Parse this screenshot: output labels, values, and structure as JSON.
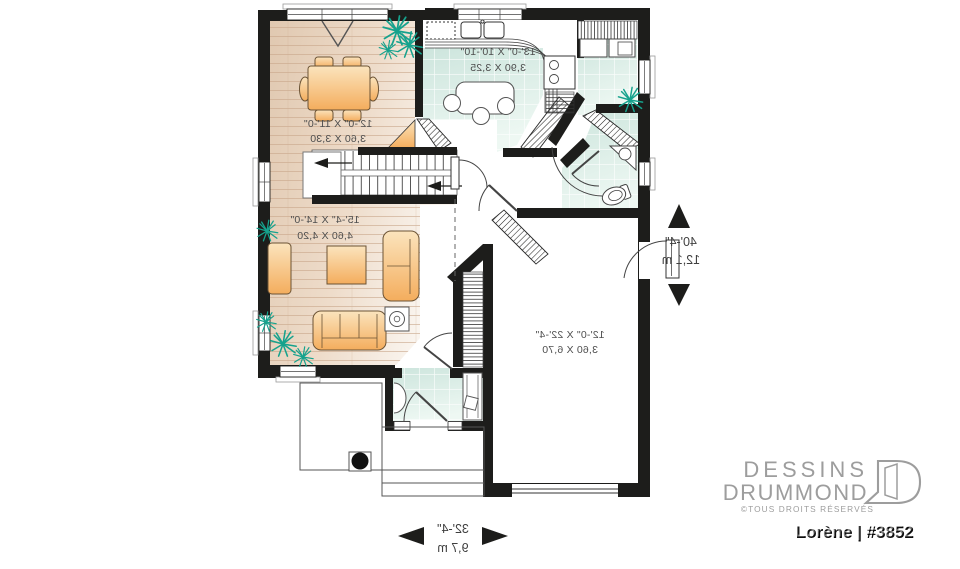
{
  "plan": {
    "rooms": {
      "dining": {
        "imperial": "12'-0\" X 11'-0\"",
        "metric": "3,60 X 3,30"
      },
      "kitchen": {
        "imperial": "13'-0\" X 10'-10\"",
        "metric": "3,90 X 3,25"
      },
      "living": {
        "imperial": "15'-4\" X 14'-0\"",
        "metric": "4,60 X 4,20"
      },
      "garage": {
        "imperial": "12'-0\" X 22'-4\"",
        "metric": "3,60 X 6,70"
      }
    },
    "overall_depth": {
      "imperial": "40'-4\"",
      "metric": "12,1 m"
    },
    "overall_width": {
      "imperial": "32'-4\"",
      "metric": "9,7 m"
    },
    "text_mirrored": true
  },
  "branding": {
    "company_line1": "DESSINS",
    "company_line2": "DRUMMOND",
    "rights_notice": "©TOUS DROITS RÉSERVÉS",
    "plan_title": "Lorène | #3852"
  },
  "colors": {
    "wall": "#1d1d1b",
    "wood_floor": "#e8d4c0",
    "tile_floor": "#d8ebe4",
    "furniture": "#f6bb74",
    "plant": "#16a28d",
    "label_text": "#4e4e4e",
    "logo_gray": "#9d9d9d",
    "title_text": "#111111"
  }
}
